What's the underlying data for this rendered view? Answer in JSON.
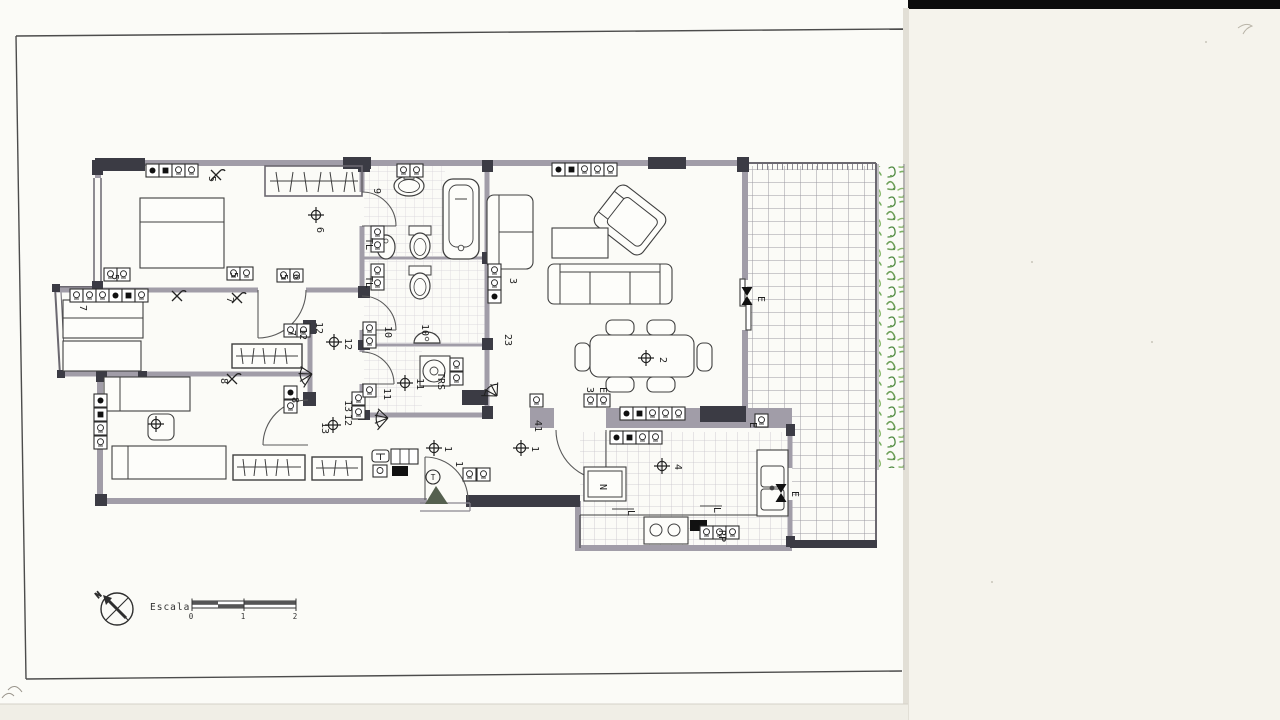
{
  "document": {
    "kind": "scanned architectural floor plan (electrical layout)",
    "compass": {
      "north_label": "N"
    },
    "scale_bar": {
      "caption": "Escala",
      "ticks": [
        "0",
        "1",
        "2"
      ]
    },
    "colors": {
      "paper_left": "#fbfbf7",
      "paper_right": "#f5f3ec",
      "top_strip": "#0c0c0c",
      "wall_gray": "#a19da8",
      "wall_pier": "#3b3b44",
      "plant_green": "#6fa05a",
      "tile_line": "#9b98a2"
    }
  },
  "labels": [
    {
      "t": "5"
    },
    {
      "t": "5"
    },
    {
      "t": "5"
    },
    {
      "t": "6"
    },
    {
      "t": "7"
    },
    {
      "t": "7"
    },
    {
      "t": "5"
    },
    {
      "t": "6"
    },
    {
      "t": "9"
    },
    {
      "t": "TL"
    },
    {
      "t": "TL"
    },
    {
      "t": "10"
    },
    {
      "t": "10"
    },
    {
      "t": "23"
    },
    {
      "t": "3"
    },
    {
      "t": "11"
    },
    {
      "t": "11"
    },
    {
      "t": "TRS"
    },
    {
      "t": "7"
    },
    {
      "t": "12"
    },
    {
      "t": "12"
    },
    {
      "t": "8"
    },
    {
      "t": "8"
    },
    {
      "t": "13"
    },
    {
      "t": "12"
    },
    {
      "t": "13"
    },
    {
      "t": "1"
    },
    {
      "t": "1"
    },
    {
      "t": "1"
    },
    {
      "t": "41"
    },
    {
      "t": "2"
    },
    {
      "t": "4"
    },
    {
      "t": "3"
    },
    {
      "t": "E"
    },
    {
      "t": "E"
    },
    {
      "t": "E"
    },
    {
      "t": "E"
    },
    {
      "t": "N"
    },
    {
      "t": "RP"
    },
    {
      "t": "L"
    },
    {
      "t": "L"
    },
    {
      "t": "12"
    },
    {
      "t": "N"
    },
    {
      "t": "Escala"
    },
    {
      "t": "0"
    },
    {
      "t": "1"
    },
    {
      "t": "2"
    },
    {
      "t": "T"
    }
  ]
}
